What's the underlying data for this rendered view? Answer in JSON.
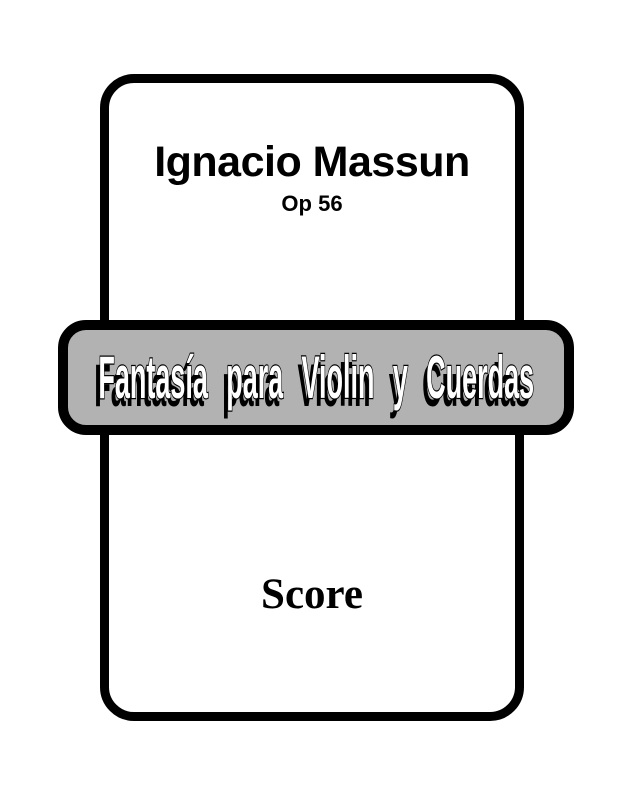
{
  "cover": {
    "composer": "Ignacio Massun",
    "opus": "Op 56",
    "work_title": "Fantasía para Violin y Cuerdas",
    "part_label": "Score"
  },
  "colors": {
    "background": "#ffffff",
    "text": "#000000",
    "frame_border": "#000000",
    "banner_fill": "#b2b2b2",
    "banner_border": "#000000",
    "banner_text_fill": "#ffffff",
    "banner_text_outline": "#000000"
  }
}
